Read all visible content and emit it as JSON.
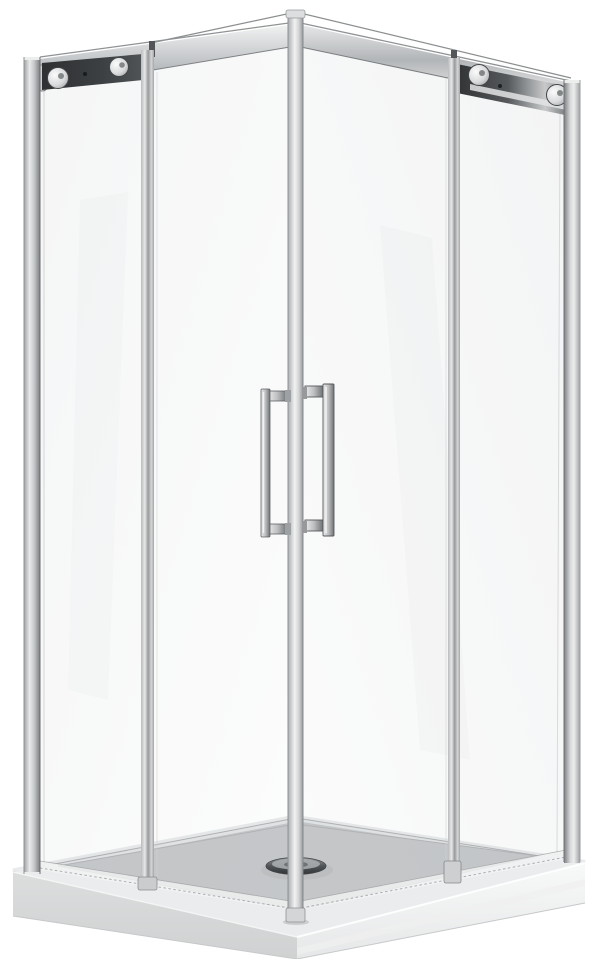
{
  "scene": {
    "description": "Product photo: square corner-entry shower enclosure with chrome frame, two sliding glass doors meeting at a front corner post with twin vertical bar handles, top roller rails with chrome wheels, standing on a low white shower tray with a round chrome drain",
    "kind": "product-photo"
  },
  "colors": {
    "bg": "#ffffff",
    "chrome_light": "#f2f3f3",
    "chrome_mid": "#b9bcbe",
    "chrome_dark": "#86898b",
    "chrome_edge": "#6b6e70",
    "bracket_dark": "#2e3032",
    "bracket_mid": "#515456",
    "roller_hi": "#fbfbfb",
    "roller_lo": "#8e9193",
    "glass_tint": "#9aa2a6",
    "tray_surface": "#c9cbcc",
    "tray_surface_dark": "#bfc1c3",
    "tray_rim": "#ecedee",
    "tray_face_left": "#dcdddd",
    "tray_face_right": "#f8f9f9",
    "tray_edge": "#c0c2c4",
    "seal_white": "#f2f4f4",
    "drain_top": "#9a9d9f",
    "drain_deep": "#2e3032"
  }
}
